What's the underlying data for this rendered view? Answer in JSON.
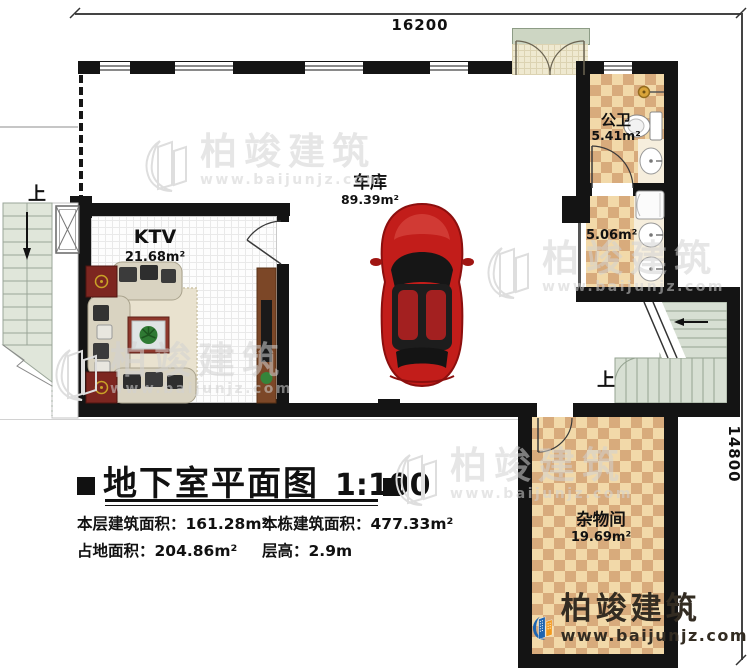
{
  "plan": {
    "title": "地下室平面图",
    "scale": "1:100",
    "dim_top": "16200",
    "dim_right": "14800",
    "up_label": "上",
    "stats": {
      "floor_area_label": "本层建筑面积：",
      "floor_area_value": "161.28m²",
      "building_area_label": "本栋建筑面积：",
      "building_area_value": "477.33m²",
      "footprint_label": "占地面积：",
      "footprint_value": "204.86m²",
      "height_label": "层高：",
      "height_value": "2.9m"
    },
    "rooms": {
      "ktv": {
        "name": "KTV",
        "area": "21.68m²"
      },
      "garage": {
        "name": "车库",
        "area": "89.39m²"
      },
      "bath": {
        "name": "公卫",
        "area": "5.41m²"
      },
      "wash": {
        "area": "5.06m²"
      },
      "storage": {
        "name": "杂物间",
        "area": "19.69m²"
      }
    }
  },
  "brand": {
    "name": "柏竣建筑",
    "url": "www.baijunjz.com"
  },
  "colors": {
    "wall": "#141414",
    "tile_light": "#f2d9a9",
    "tile_dark": "#d8ab7c",
    "stair_green": "#d7dfd3",
    "car_red": "#c21d1a",
    "logo_blue": "#1d64b0",
    "logo_orange": "#f29a1d"
  }
}
